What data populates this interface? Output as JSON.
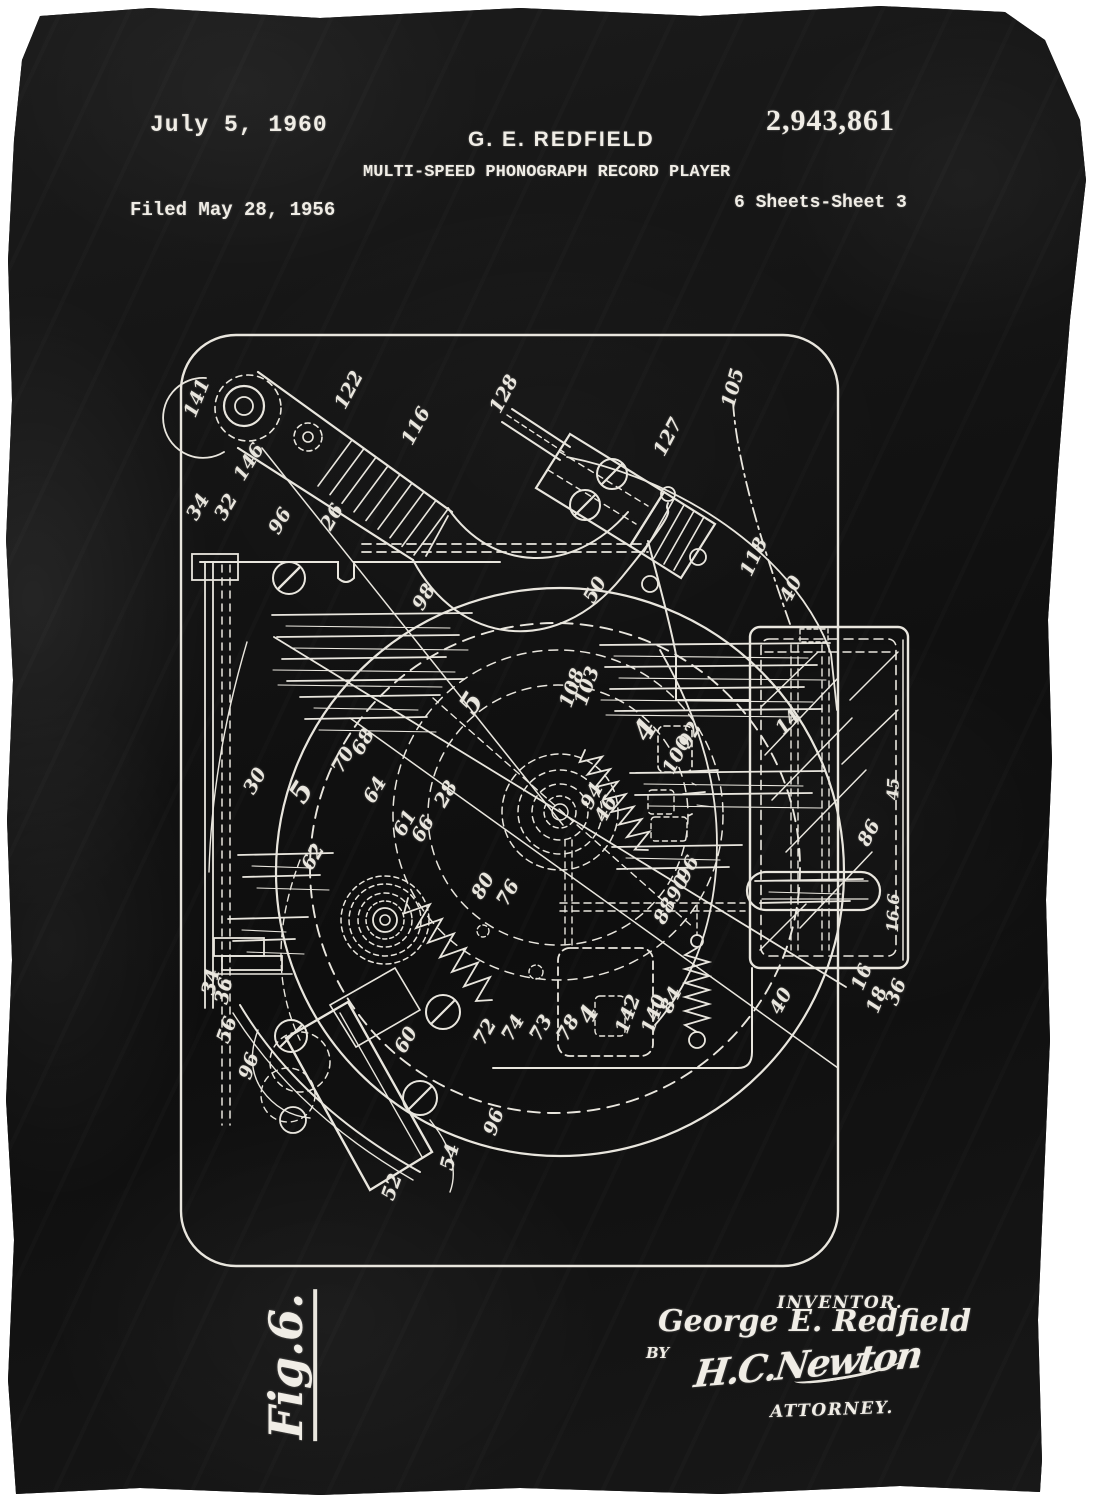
{
  "artwork": {
    "kind": "patent print on black fabric",
    "colors": {
      "backdrop": "#ffffff",
      "fabric": "#121212",
      "ink": "#e9e6de"
    }
  },
  "header": {
    "date": "July 5, 1960",
    "inventor": "G. E. REDFIELD",
    "patent_number": "2,943,861",
    "title": "MULTI-SPEED PHONOGRAPH RECORD PLAYER",
    "filed": "Filed May 28, 1956",
    "sheet": "6 Sheets-Sheet 3"
  },
  "figure": {
    "label": "Fig.6."
  },
  "signature_block": {
    "inventor_caption": "INVENTOR.",
    "inventor_name": "George E. Redfield",
    "by_label": "BY",
    "attorney_signature": "H.C.Newton",
    "attorney_caption": "ATTORNEY."
  },
  "reference_numerals": [
    {
      "t": "141",
      "x": 197,
      "y": 398,
      "r": -68
    },
    {
      "t": "122",
      "x": 349,
      "y": 390,
      "r": -62
    },
    {
      "t": "116",
      "x": 416,
      "y": 426,
      "r": -62
    },
    {
      "t": "128",
      "x": 504,
      "y": 394,
      "r": -62
    },
    {
      "t": "105",
      "x": 733,
      "y": 388,
      "r": -75
    },
    {
      "t": "127",
      "x": 668,
      "y": 437,
      "r": -62
    },
    {
      "t": "146",
      "x": 249,
      "y": 462,
      "r": -58
    },
    {
      "t": "34",
      "x": 198,
      "y": 507,
      "r": -60
    },
    {
      "t": "32",
      "x": 226,
      "y": 507,
      "r": -60
    },
    {
      "t": "96",
      "x": 280,
      "y": 521,
      "r": -60
    },
    {
      "t": "26",
      "x": 332,
      "y": 517,
      "r": -60
    },
    {
      "t": "118",
      "x": 754,
      "y": 557,
      "r": -65
    },
    {
      "t": "40",
      "x": 791,
      "y": 589,
      "r": -62
    },
    {
      "t": "50",
      "x": 595,
      "y": 590,
      "r": -60
    },
    {
      "t": "98",
      "x": 424,
      "y": 597,
      "r": -60
    },
    {
      "t": "92",
      "x": 690,
      "y": 735,
      "r": -62
    },
    {
      "t": "100",
      "x": 677,
      "y": 755,
      "r": -62
    },
    {
      "t": "108",
      "x": 572,
      "y": 688,
      "r": -70
    },
    {
      "t": "103",
      "x": 587,
      "y": 686,
      "r": -70
    },
    {
      "t": "4",
      "x": 645,
      "y": 730,
      "r": -58,
      "s": 28
    },
    {
      "t": "5",
      "x": 471,
      "y": 703,
      "r": -58,
      "s": 28
    },
    {
      "t": "5",
      "x": 301,
      "y": 792,
      "r": -58,
      "s": 28
    },
    {
      "t": "30",
      "x": 255,
      "y": 781,
      "r": -60
    },
    {
      "t": "70",
      "x": 343,
      "y": 760,
      "r": -60
    },
    {
      "t": "68",
      "x": 363,
      "y": 742,
      "r": -60
    },
    {
      "t": "64",
      "x": 375,
      "y": 790,
      "r": -60
    },
    {
      "t": "61",
      "x": 405,
      "y": 823,
      "r": -60
    },
    {
      "t": "66",
      "x": 423,
      "y": 829,
      "r": -60
    },
    {
      "t": "28",
      "x": 446,
      "y": 794,
      "r": -60
    },
    {
      "t": "62",
      "x": 313,
      "y": 857,
      "r": -60
    },
    {
      "t": "80",
      "x": 483,
      "y": 886,
      "r": -60
    },
    {
      "t": "76",
      "x": 508,
      "y": 893,
      "r": -60
    },
    {
      "t": "94",
      "x": 592,
      "y": 796,
      "r": -62
    },
    {
      "t": "46",
      "x": 606,
      "y": 809,
      "r": -62
    },
    {
      "t": "96",
      "x": 688,
      "y": 869,
      "r": -62
    },
    {
      "t": "90",
      "x": 678,
      "y": 888,
      "r": -62
    },
    {
      "t": "88",
      "x": 665,
      "y": 911,
      "r": -62
    },
    {
      "t": "16.6",
      "x": 893,
      "y": 913,
      "r": -88,
      "s": 16
    },
    {
      "t": "45",
      "x": 893,
      "y": 789,
      "r": -88,
      "s": 16
    },
    {
      "t": "86",
      "x": 869,
      "y": 833,
      "r": -62
    },
    {
      "t": "14",
      "x": 788,
      "y": 722,
      "r": -45
    },
    {
      "t": "16",
      "x": 862,
      "y": 977,
      "r": -68
    },
    {
      "t": "18",
      "x": 877,
      "y": 1000,
      "r": -68
    },
    {
      "t": "36",
      "x": 896,
      "y": 992,
      "r": -68
    },
    {
      "t": "40",
      "x": 781,
      "y": 1001,
      "r": -62
    },
    {
      "t": "84",
      "x": 671,
      "y": 1000,
      "r": -64
    },
    {
      "t": "140",
      "x": 654,
      "y": 1014,
      "r": -70
    },
    {
      "t": "142",
      "x": 628,
      "y": 1014,
      "r": -70
    },
    {
      "t": "4",
      "x": 588,
      "y": 1014,
      "r": -60,
      "s": 24
    },
    {
      "t": "78",
      "x": 568,
      "y": 1028,
      "r": -60
    },
    {
      "t": "73",
      "x": 541,
      "y": 1028,
      "r": -60
    },
    {
      "t": "74",
      "x": 513,
      "y": 1028,
      "r": -60
    },
    {
      "t": "72",
      "x": 485,
      "y": 1032,
      "r": -60
    },
    {
      "t": "60",
      "x": 406,
      "y": 1040,
      "r": -60
    },
    {
      "t": "34",
      "x": 211,
      "y": 982,
      "r": -78
    },
    {
      "t": "36",
      "x": 224,
      "y": 991,
      "r": -78
    },
    {
      "t": "56",
      "x": 227,
      "y": 1030,
      "r": -70
    },
    {
      "t": "96",
      "x": 249,
      "y": 1066,
      "r": -70
    },
    {
      "t": "96",
      "x": 494,
      "y": 1122,
      "r": -70
    },
    {
      "t": "54",
      "x": 450,
      "y": 1157,
      "r": -75
    },
    {
      "t": "52",
      "x": 392,
      "y": 1187,
      "r": -70
    }
  ]
}
